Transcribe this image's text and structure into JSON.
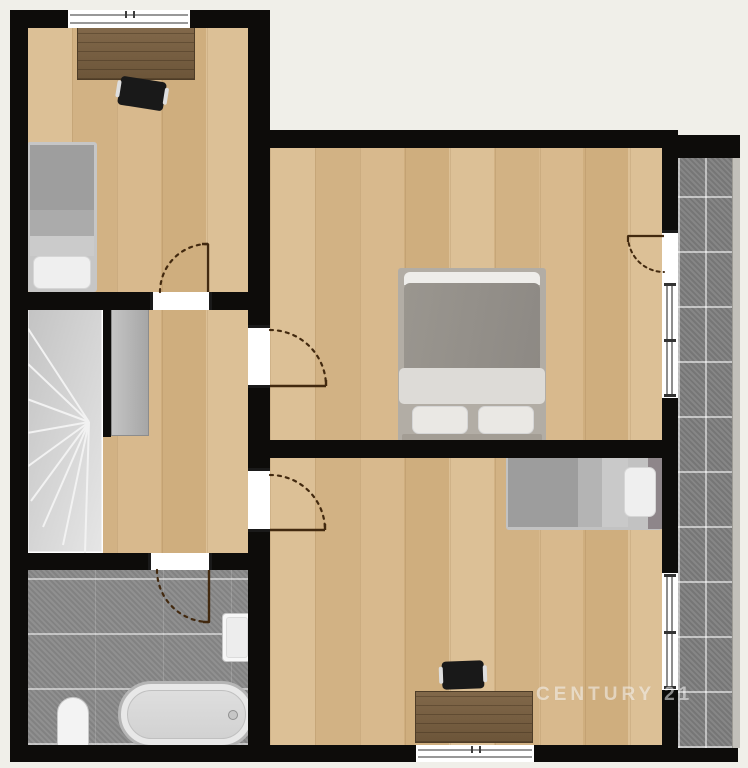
{
  "meta": {
    "type": "floor-plan",
    "style": "2d-top-down",
    "branding": "real-estate listing plan"
  },
  "watermark": {
    "text": "CENTURY 21"
  },
  "palette": {
    "bg": "#f0efe9",
    "wall": "#0d0c0a",
    "wood_floor_light": "#dcc096",
    "wood_floor_dark": "#cfae7e",
    "desk_wood": "#77613f",
    "bathroom_tile": "#8a8a8a",
    "balcony_tile": "#7f7f7f",
    "stairs_gray": "#d4d4d4",
    "furniture_gray": "#9e9e9e",
    "fixture": "#f5f5f5",
    "swing": "#42290f",
    "watermark": "rgba(255,255,255,0.52)"
  },
  "rooms": [
    {
      "id": "bedroom-1",
      "position": "top-left",
      "floor": "wood",
      "furniture": [
        "desk",
        "office-chair",
        "single-bed"
      ]
    },
    {
      "id": "hallway-landing",
      "position": "middle-left",
      "floor": "wood",
      "furniture": [
        "winder-staircase",
        "wardrobe"
      ]
    },
    {
      "id": "bathroom",
      "position": "bottom-left",
      "floor": "gray-tile",
      "furniture": [
        "bathtub",
        "toilet",
        "washbasin"
      ]
    },
    {
      "id": "master-bedroom",
      "position": "center-right",
      "floor": "wood",
      "furniture": [
        "double-bed"
      ]
    },
    {
      "id": "bedroom-2",
      "position": "bottom-right",
      "floor": "wood",
      "furniture": [
        "single-bed",
        "desk",
        "office-chair"
      ]
    },
    {
      "id": "balcony",
      "position": "right-strip",
      "floor": "dark-tile",
      "furniture": []
    }
  ],
  "openings": {
    "interior_doors": 4,
    "balcony_doors": 1,
    "windows": 4
  }
}
